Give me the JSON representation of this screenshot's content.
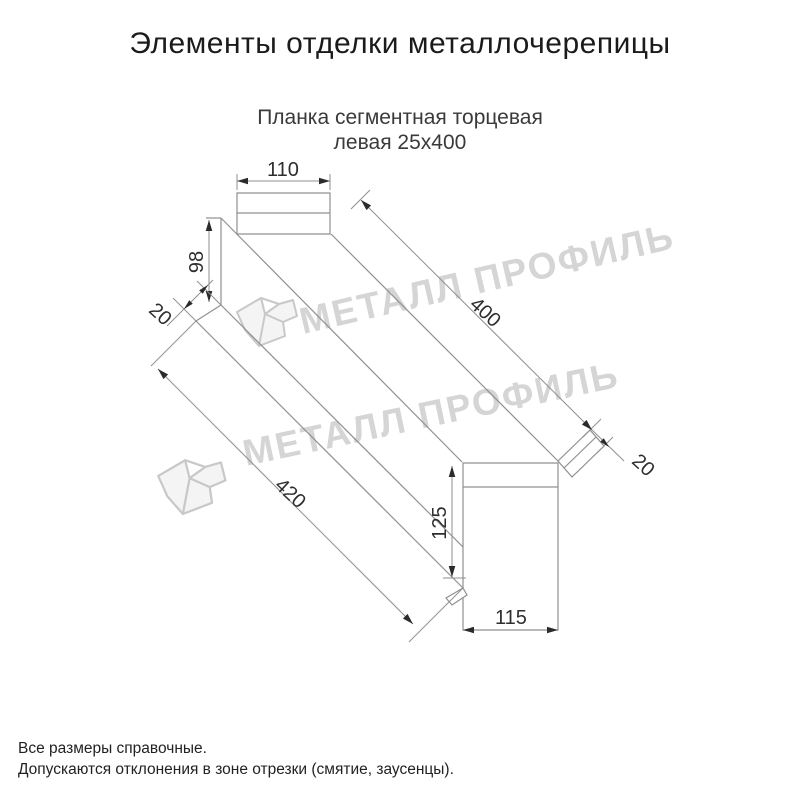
{
  "title": "Элементы отделки металлочерепицы",
  "subtitle": {
    "line1": "Планка сегментная торцевая",
    "line2": "левая 25х400"
  },
  "watermark": {
    "brand": "МЕТАЛЛ ПРОФИЛЬ"
  },
  "drawing": {
    "dims": {
      "top_width": "110",
      "left_height": "98",
      "left_hem": "20",
      "top_length": "400",
      "bottom_length": "420",
      "end_height": "125",
      "end_width": "115",
      "end_hem": "20"
    },
    "colors": {
      "line": "#909090",
      "dimension_text": "#2e2e2e",
      "watermark": "#d5d5d5"
    }
  },
  "notes": {
    "line1": "Все размеры справочные.",
    "line2": "Допускаются отклонения в зоне отрезки (смятие, заусенцы)."
  }
}
